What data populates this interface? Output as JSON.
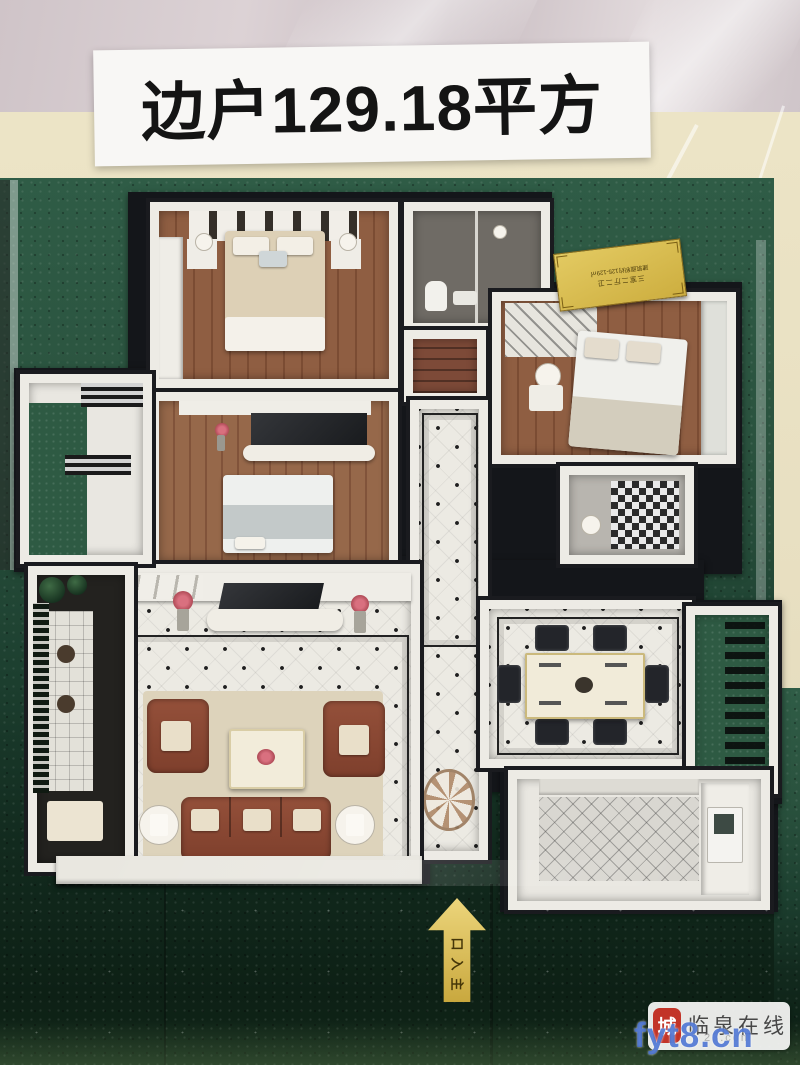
{
  "photo": {
    "banner": {
      "text": "边户129.18平方"
    },
    "plaque": {
      "line1": "三室二厅二卫",
      "line2": "建筑面积约125-129㎡"
    },
    "entrance_arrow": {
      "label": "主入口"
    },
    "watermark": {
      "seal_char": "城",
      "site_name": "临泉在线",
      "faint_text": "23.com",
      "url": "fyt8.cn"
    },
    "colors": {
      "banner_bg": "#f8f7f5",
      "banner_text": "#141414",
      "wall_beige": "#e8e0c2",
      "turf_green": "#2a523e",
      "turf_dark": "#0d2015",
      "model_base": "#14161a",
      "wall_white": "#edebe5",
      "wood_floor": "#8f5e42",
      "tile_floor": "#eceae3",
      "sofa_brown": "#8a4632",
      "plaque_gold": "#d8bc54",
      "arrow_gold": "#d8b84e",
      "watermark_blue": "#3a67ce",
      "seal_red": "#c23428"
    }
  }
}
